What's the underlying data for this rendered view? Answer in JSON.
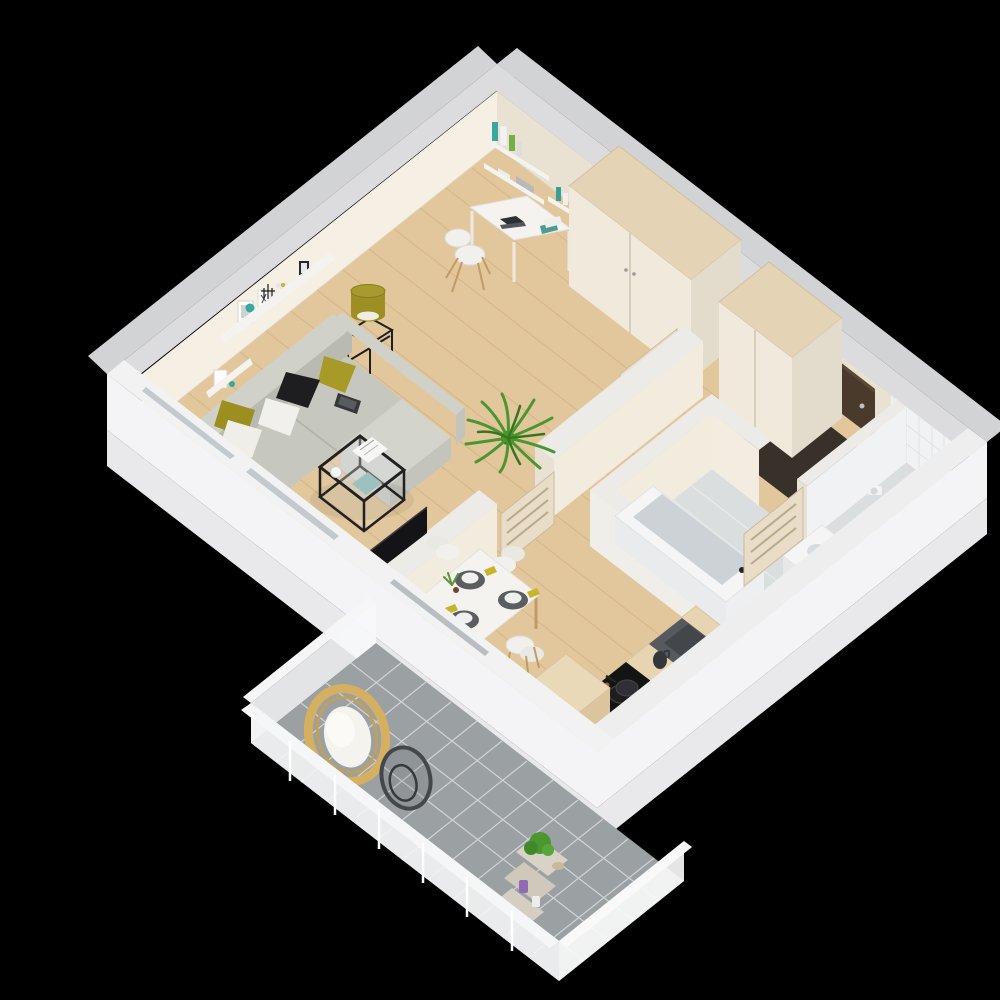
{
  "scene": {
    "kind": "3d-isometric-floor-plan-render",
    "description": "Photorealistic top-down isometric 3D rendering of a one-bedroom apartment with balcony on a black background",
    "background": "#000000"
  },
  "rooms": [
    {
      "name": "living-room",
      "floor": "light-oak",
      "items": [
        "sofa",
        "pillows",
        "wall-shelf",
        "coffee-table",
        "side-table-lamp",
        "palm-plant",
        "tv-on-partition"
      ]
    },
    {
      "name": "study-corner",
      "items": [
        "desk",
        "desk-chair",
        "laptop",
        "wall-bookshelves",
        "books"
      ]
    },
    {
      "name": "hall-entry",
      "items": [
        "wardrobe",
        "second-wardrobe",
        "entry-door",
        "door-mat",
        "intercom",
        "open-interior-doors"
      ]
    },
    {
      "name": "dining-area",
      "items": [
        "dining-table",
        "four-chairs",
        "place-settings",
        "napkins",
        "centerpiece"
      ]
    },
    {
      "name": "bathroom",
      "floor": "grey",
      "items": [
        "bathtub",
        "toilet",
        "toilet-paper-holder",
        "sink-cabinet",
        "tiled-walls",
        "bathroom-door"
      ]
    },
    {
      "name": "kitchen",
      "items": [
        "counter",
        "cooktop",
        "pan",
        "sink",
        "kettle",
        "island-cabinet"
      ]
    },
    {
      "name": "balcony",
      "floor": "grey-tile",
      "items": [
        "hanging-egg-chair",
        "metal-chair-frame",
        "ladder-shelf",
        "potted-plant",
        "candle"
      ]
    }
  ],
  "colors": {
    "background": "#000000",
    "outer_band": "#d2d3d5",
    "wall_cap": "#dcdcde",
    "wall_face": "#f5efe4",
    "wall_face_shade": "#e9e1d2",
    "partition_cap": "#edebe7",
    "white_wall": "#f4f4f6",
    "white_wall_slab": "#e9e9eb",
    "wood_floor": "#e3c79c",
    "wood_line": "#c9a878",
    "bath_floor": "#dbdedf",
    "balcony_tile": "#9ba0a3",
    "balcony_grout": "#d7d9da",
    "sofa_light": "#d0d1c9",
    "sofa_mid": "#c6c7bf",
    "sofa_dark": "#b9bab2",
    "pillow_olive": "#a89a28",
    "pillow_black": "#1e1e20",
    "pillow_white": "#f1f0ec",
    "entry_door": "#4a3a2b",
    "door_mat": "#38312a",
    "wardrobe_top": "#e4d3b4",
    "wardrobe_front": "#f0e9dc",
    "wardrobe_side": "#e3dccc",
    "door_leaf": "#e9ddc7",
    "tv_black": "#141416",
    "table_white": "#f5f3ef",
    "chair_shell": "#f1f0ec",
    "wood_leg": "#c49a63",
    "placemat": "#5b5e60",
    "napkin": "#c8b32b",
    "counter_wood": "#e7d5b2",
    "cooktop": "#141414",
    "sink_dark": "#565a5e",
    "island_top": "#ead9b8",
    "tub_inner": "#ccd2d5",
    "fixture_white": "#f5f5f6",
    "plant_green": "#4c9630",
    "plant_dark": "#37751f",
    "rattan": "#d5b061",
    "cushion": "#f5f3ee",
    "metal": "#45484b",
    "lamp_olive": "#9d8f24",
    "glass": "#c3c9cd",
    "shelf_white": "#f4f3f0",
    "teal": "#3aa79e"
  }
}
